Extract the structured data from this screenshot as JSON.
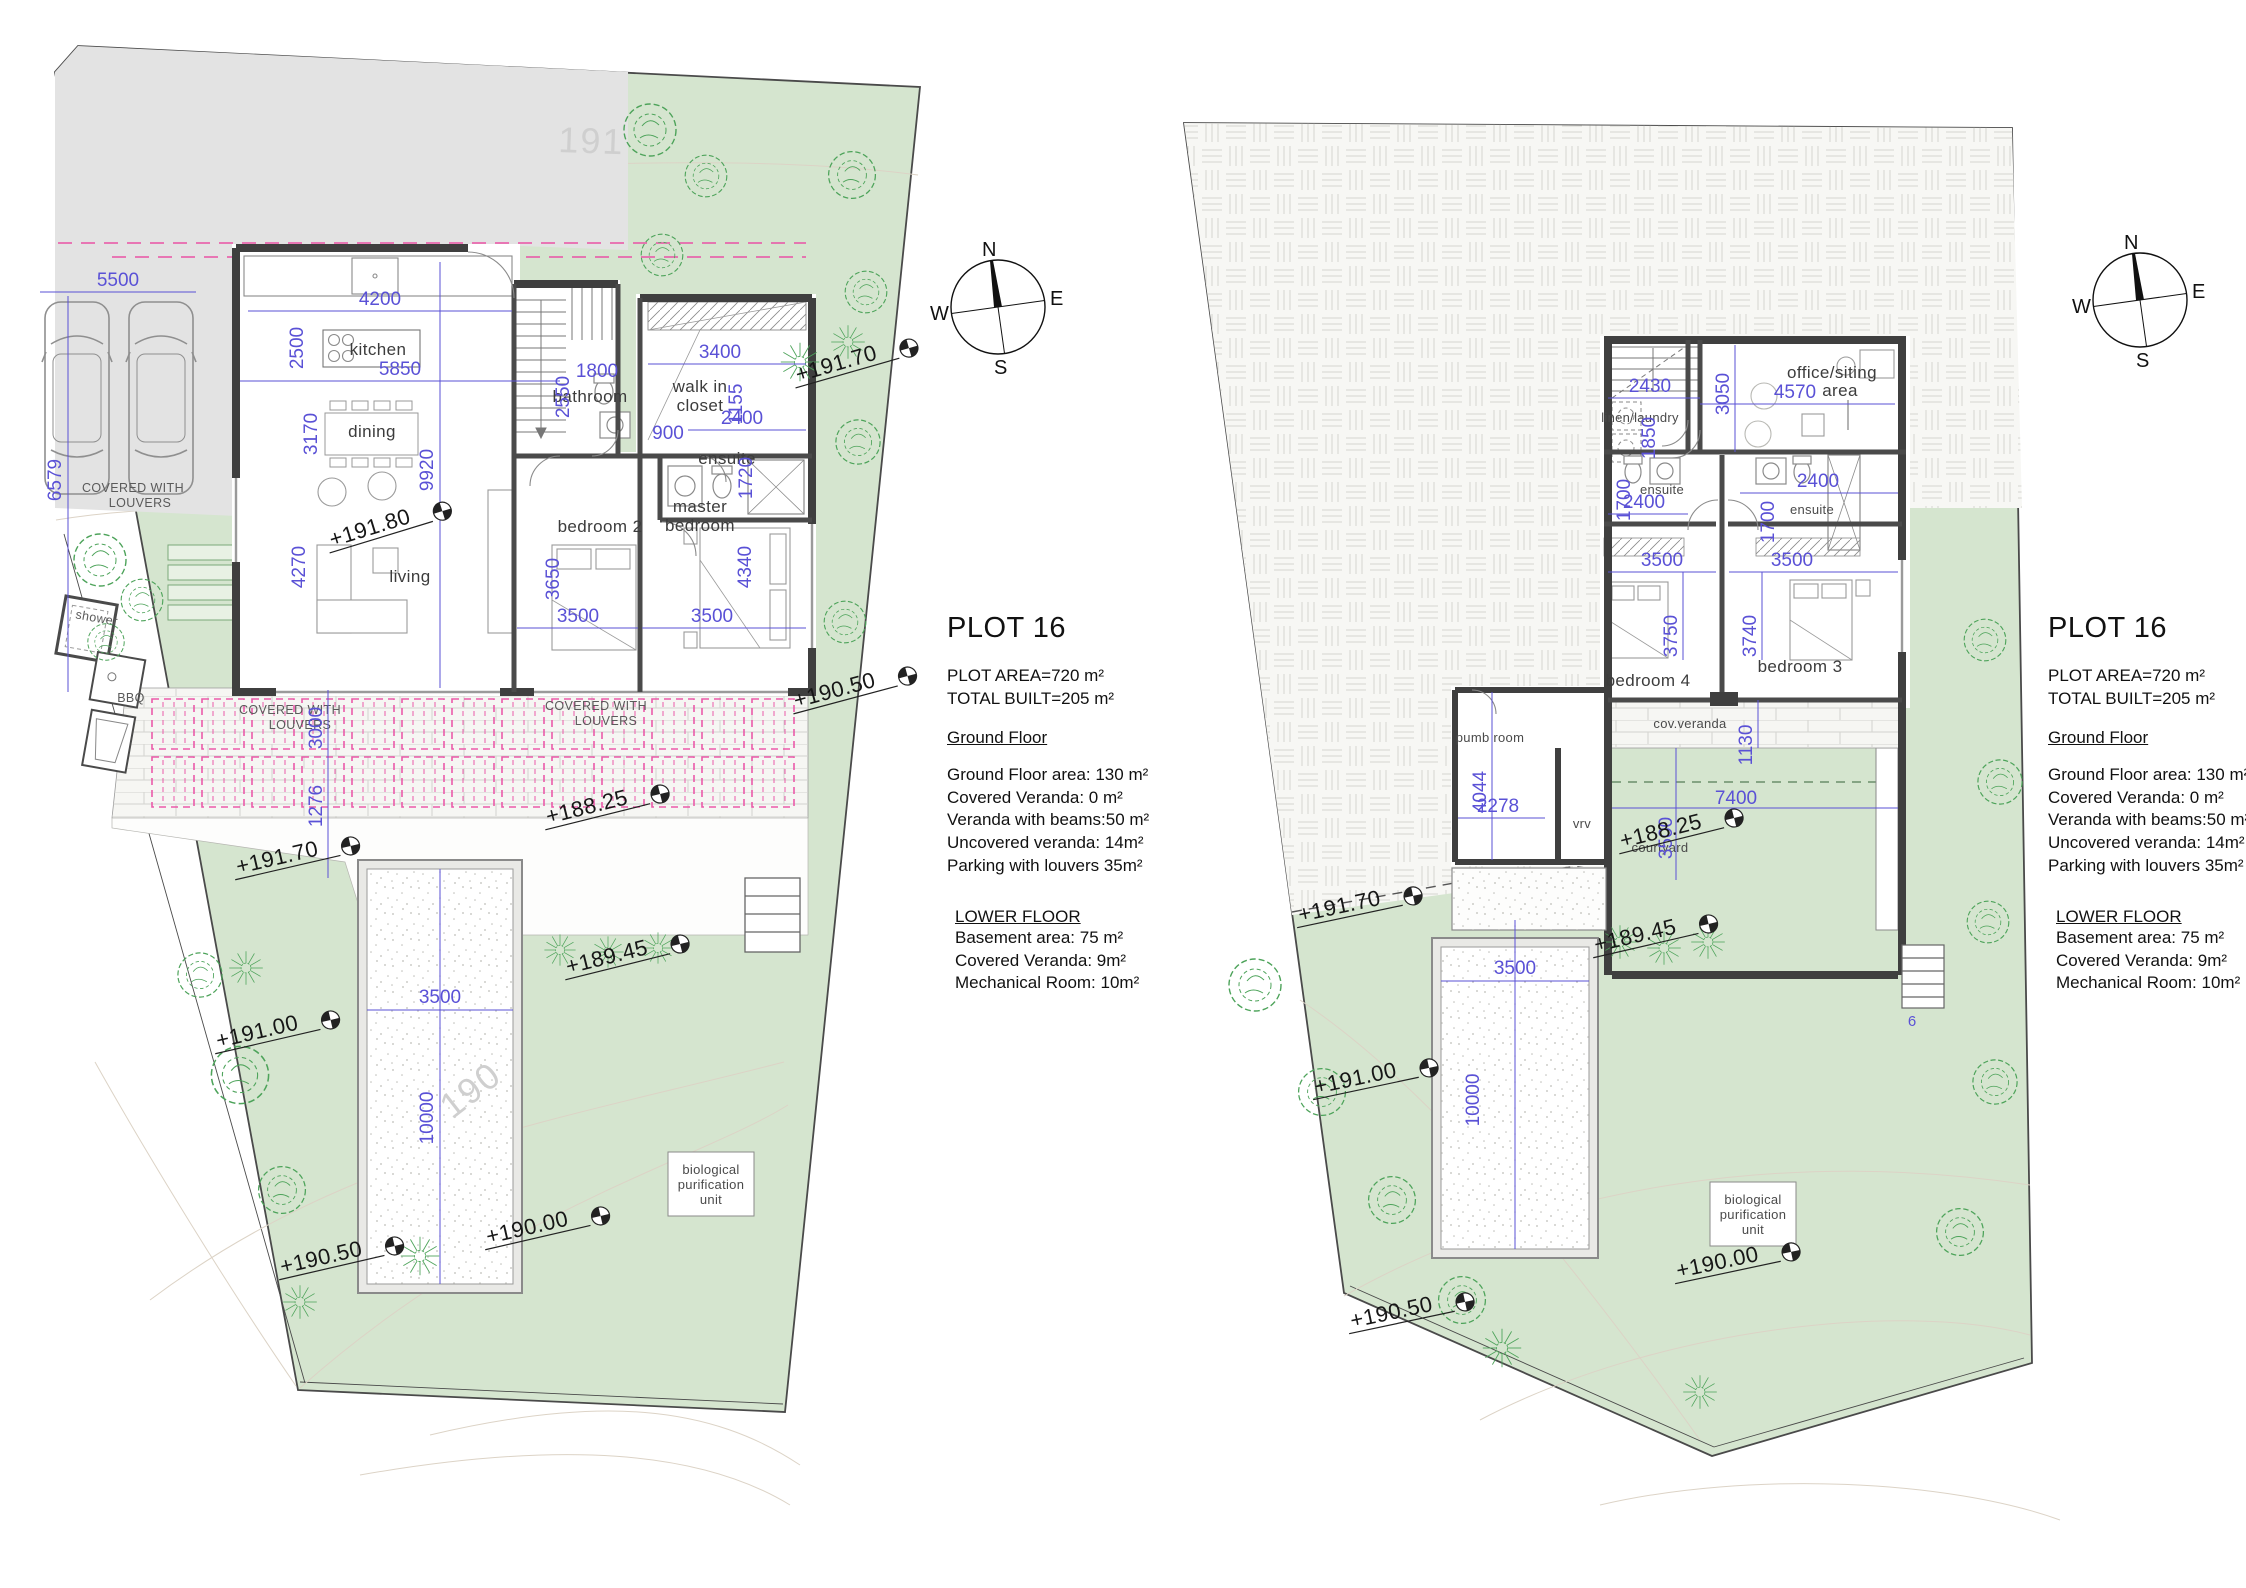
{
  "info_panel": {
    "title": "PLOT 16",
    "plot_area": "PLOT AREA=720 m²",
    "total_built": "TOTAL BUILT=205 m²",
    "ground_floor": {
      "heading": "Ground Floor",
      "lines": [
        "Ground Floor area: 130 m²",
        "Covered Veranda: 0 m²",
        "Veranda with beams:50 m²",
        "Uncovered veranda: 14m²",
        "Parking with louvers 35m²"
      ]
    },
    "lower_floor": {
      "heading": "LOWER FLOOR",
      "lines": [
        "Basement area: 75 m²",
        "Covered Veranda: 9m²",
        "Mechanical Room: 10m²"
      ]
    }
  },
  "compass": {
    "north": "N",
    "east": "E",
    "south": "S",
    "west": "W"
  },
  "ground_floor_plan": {
    "rooms": {
      "kitchen": "kitchen",
      "dining": "dining",
      "living": "living",
      "bedroom2": "bedroom 2",
      "master_bedroom": [
        "master",
        "bedroom"
      ],
      "bathroom": "bathroom",
      "walk_in_closet": [
        "walk in",
        "closet"
      ],
      "ensuite": "ensuite"
    },
    "site": {
      "parking_label": [
        "COVERED WITH",
        "LOUVERS"
      ],
      "veranda_label_1": [
        "COVERED WITH",
        "LOUVERS"
      ],
      "veranda_label_2": [
        "COVERED WITH",
        "LOUVERS"
      ],
      "shower": "shower",
      "bbq": "BBQ",
      "bio_unit": [
        "biological",
        "purification",
        "unit"
      ],
      "contour_191": "191",
      "contour_190": "190"
    },
    "levels": {
      "l1": "+191.70",
      "l2": "+191.80",
      "l3": "+190.50",
      "l4": "+188.25",
      "l5": "+191.70",
      "l6": "+189.45",
      "l7": "+191.00",
      "l8": "+190.00",
      "l9": "+190.50"
    },
    "dims": {
      "parking_w": "5500",
      "parking_d": "6579",
      "kitchen_w": "4200",
      "kitchen_d": "2500",
      "living_w": "5850",
      "dining_d": "3170",
      "living_d": "9920",
      "living_d2": "4270",
      "bath_w": "1800",
      "bath_d": "2550",
      "closet_w": "3400",
      "closet_d": "1155",
      "ensuite_w": "2400",
      "hall_w": "900",
      "ensuite_d": "1720",
      "bed2_d": "3650",
      "bed2_w": "3500",
      "master_w": "3500",
      "master_d": "4340",
      "veranda_d": "3000",
      "terrace_d": "1276",
      "pool_w": "3500",
      "pool_l": "10000"
    }
  },
  "lower_floor_plan": {
    "rooms": {
      "office": [
        "office/siting",
        "area"
      ],
      "linen_laundry": "linen/laundry",
      "ensuite_left": "ensuite",
      "ensuite_right": "ensuite",
      "bedroom4": "bedroom 4",
      "bedroom3": "bedroom 3",
      "cov_veranda": "cov.veranda",
      "courtyard": "courtyard",
      "pump_room": "pumb room",
      "vrv": "vrv"
    },
    "site": {
      "bio_unit": [
        "biological",
        "purification",
        "unit"
      ]
    },
    "levels": {
      "l1": "+188.25",
      "l2": "+191.70",
      "l3": "+191.00",
      "l4": "+190.50",
      "l5": "+189.45",
      "l6": "+190.00"
    },
    "dims": {
      "stair_w": "2430",
      "laundry_d": "1850",
      "office_d": "3050",
      "office_w": "4570",
      "ensl_d": "1700",
      "ensl_w": "2400",
      "ensr_w": "2400",
      "ensr_d": "1700",
      "bed4_w": "3500",
      "bed4_d": "3750",
      "bed3_w": "3500",
      "bed3_d": "3740",
      "veranda_d": "1130",
      "pump_d": "4044",
      "pump_w": "2278",
      "court_d": "3500",
      "court_w": "7400",
      "pool_w": "3500",
      "pool_l": "10000",
      "stair_count": "6"
    }
  }
}
